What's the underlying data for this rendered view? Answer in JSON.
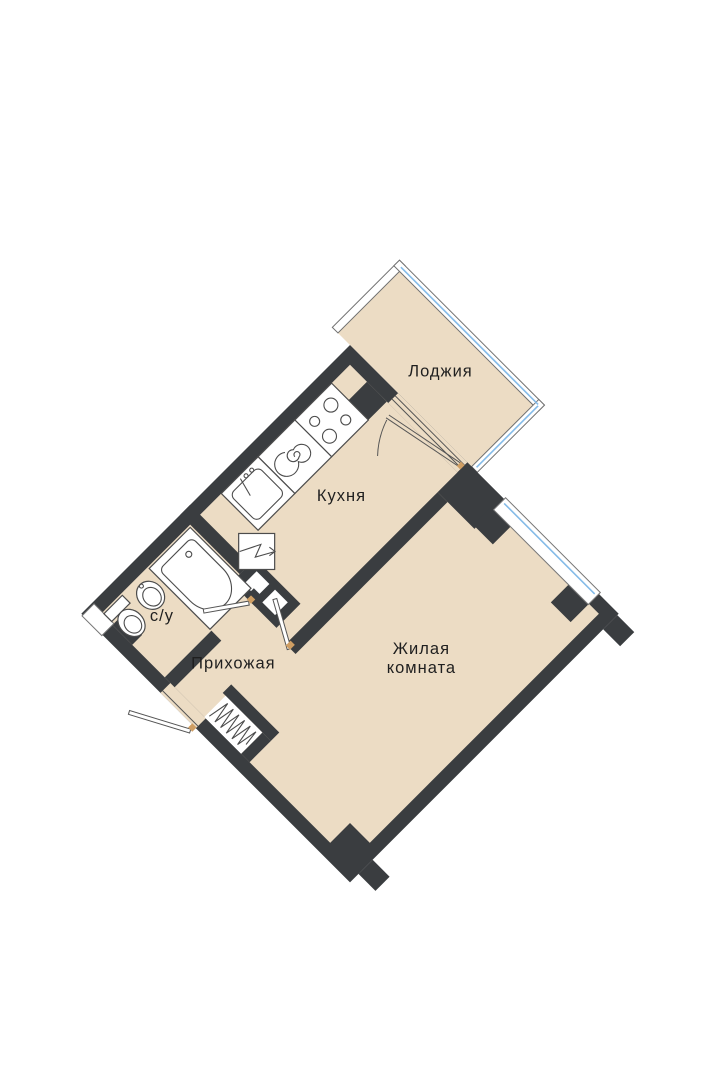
{
  "plan": {
    "title": "Apartment floor plan (1-room, rotated 45°)",
    "rooms": {
      "loggia": {
        "label": "Лоджия"
      },
      "kitchen": {
        "label": "Кухня"
      },
      "bathroom": {
        "label": "с/у"
      },
      "hallway": {
        "label": "Прихожая"
      },
      "living_room": {
        "label_line1": "Жилая",
        "label_line2": "комната"
      }
    },
    "fixtures": [
      "stove-4-burner",
      "hob-spiral",
      "kitchen-sink",
      "electric-panel",
      "bathtub",
      "washbasin",
      "toilet",
      "duct-hatch",
      "entrance-door",
      "balcony-door",
      "room-door",
      "bathroom-door",
      "window"
    ],
    "colors": {
      "floor": "#ecdcc4",
      "wall": "#3a3d40",
      "window_glazing": "#85bbe8",
      "door_hinge": "#cf9e63",
      "fixture_outline": "#4c4c4c",
      "label_text": "#1f1f1f"
    }
  }
}
